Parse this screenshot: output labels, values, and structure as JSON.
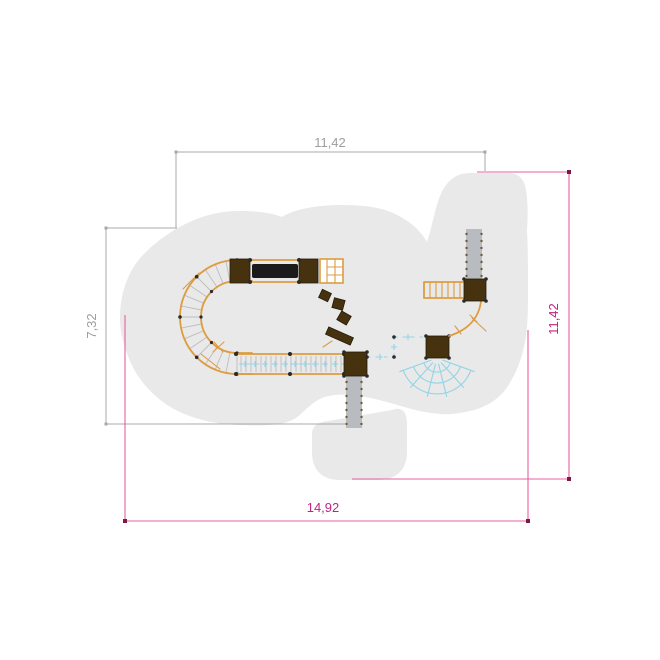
{
  "drawing": {
    "type": "playground-equipment-plan-view",
    "dimensions": {
      "top": {
        "value": "11,42"
      },
      "left": {
        "value": "7,32"
      },
      "right": {
        "value": "11,42"
      },
      "bottom": {
        "value": "14,92"
      }
    },
    "colors": {
      "safety_zone": "#e9e9ea",
      "equipment_wood": "#dd9c40",
      "equipment_dark": "#46320f",
      "bar_black": "#1b1b1b",
      "slide_gray": "#b8bbbf",
      "slide_dot": "#6f5d36",
      "rung_gray": "#bdbdbd",
      "post_dark": "#2a2a2a",
      "net_cyan": "#93d4e5",
      "dim_secondary": "#a8a8a8",
      "dim_secondary_text": "#9e9e9e",
      "dim_primary_line": "#e8609e",
      "dim_primary_text": "#bf2483",
      "dim_primary_marker": "#7e1747"
    }
  }
}
